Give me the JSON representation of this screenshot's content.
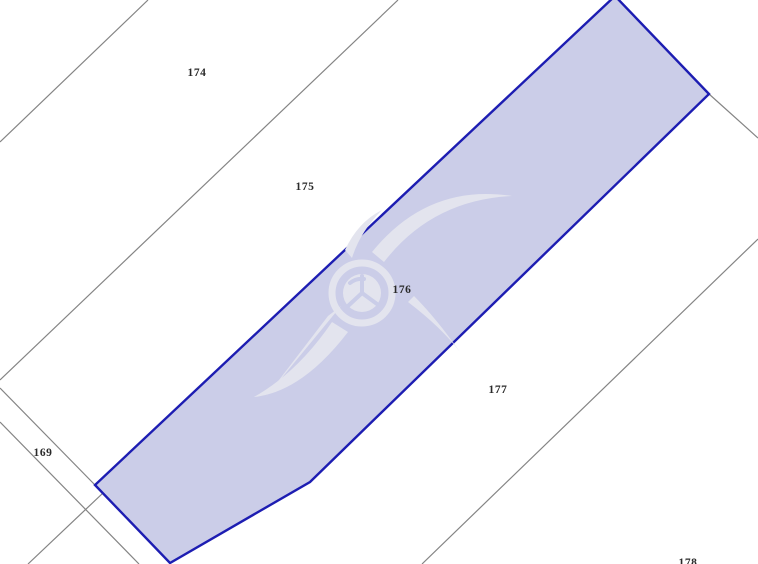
{
  "map": {
    "type": "cadastral-parcel-map",
    "colors": {
      "background": "#ffffff",
      "parcel_line": "#848484",
      "highlight_border": "#1d1db2",
      "highlight_fill": "#a0a4d5",
      "label": "#2a2a2a",
      "watermark": "#e3e4ee",
      "watermark_cut": "#cacde8"
    },
    "highlighted_parcel_id": "176",
    "parcels": {
      "labels": [
        {
          "id": "174"
        },
        {
          "id": "175"
        },
        {
          "id": "176"
        },
        {
          "id": "177"
        },
        {
          "id": "169"
        },
        {
          "id": "178"
        }
      ]
    },
    "watermark": {
      "name": "agency-logo-watermark"
    }
  }
}
